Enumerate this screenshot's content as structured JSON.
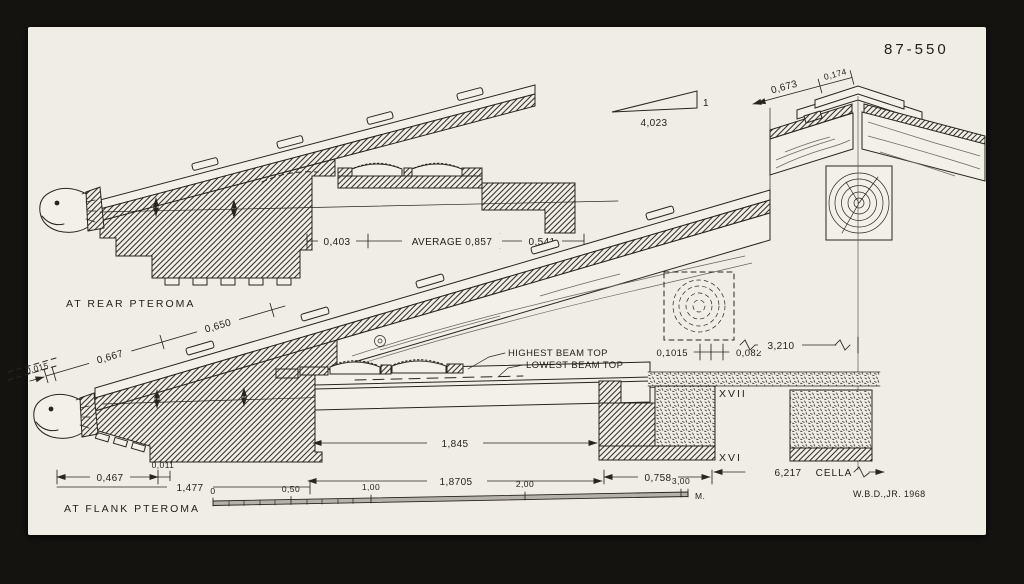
{
  "drawing": {
    "number": "87-550",
    "signature": "W.B.D.,JR. 1968",
    "labels": {
      "rear_section": "AT REAR PTEROMA",
      "flank_section": "AT FLANK PTEROMA",
      "highest_beam": "HIGHEST BEAM TOP",
      "lowest_beam": "LOWEST BEAM TOP",
      "cella": "CELLA",
      "course_xvii": "XVII",
      "course_xvi": "XVI"
    },
    "slope": {
      "run": "4,023",
      "rise": "1"
    },
    "dims": {
      "ridge_a": "0,673",
      "ridge_b": "0,174",
      "rear_a": "0,403",
      "rear_b": "AVERAGE 0,857",
      "rear_c": "0,541",
      "flank_lap": "0,015",
      "flank_a": "0,667",
      "flank_b": "0,650",
      "beam_a": "0,1015",
      "beam_b": "0,082",
      "ridge_span": "3,210",
      "overhang": "0,467",
      "joint": "0,011",
      "geison": "1,477",
      "clear_span": "1,845",
      "beam_span": "1,8705",
      "wall": "0,758",
      "cella_span": "6,217"
    },
    "scale": {
      "t0": "0",
      "t05": "0,50",
      "t1": "1,00",
      "t2": "2,00",
      "t3": "3,00",
      "unit": "M."
    }
  }
}
